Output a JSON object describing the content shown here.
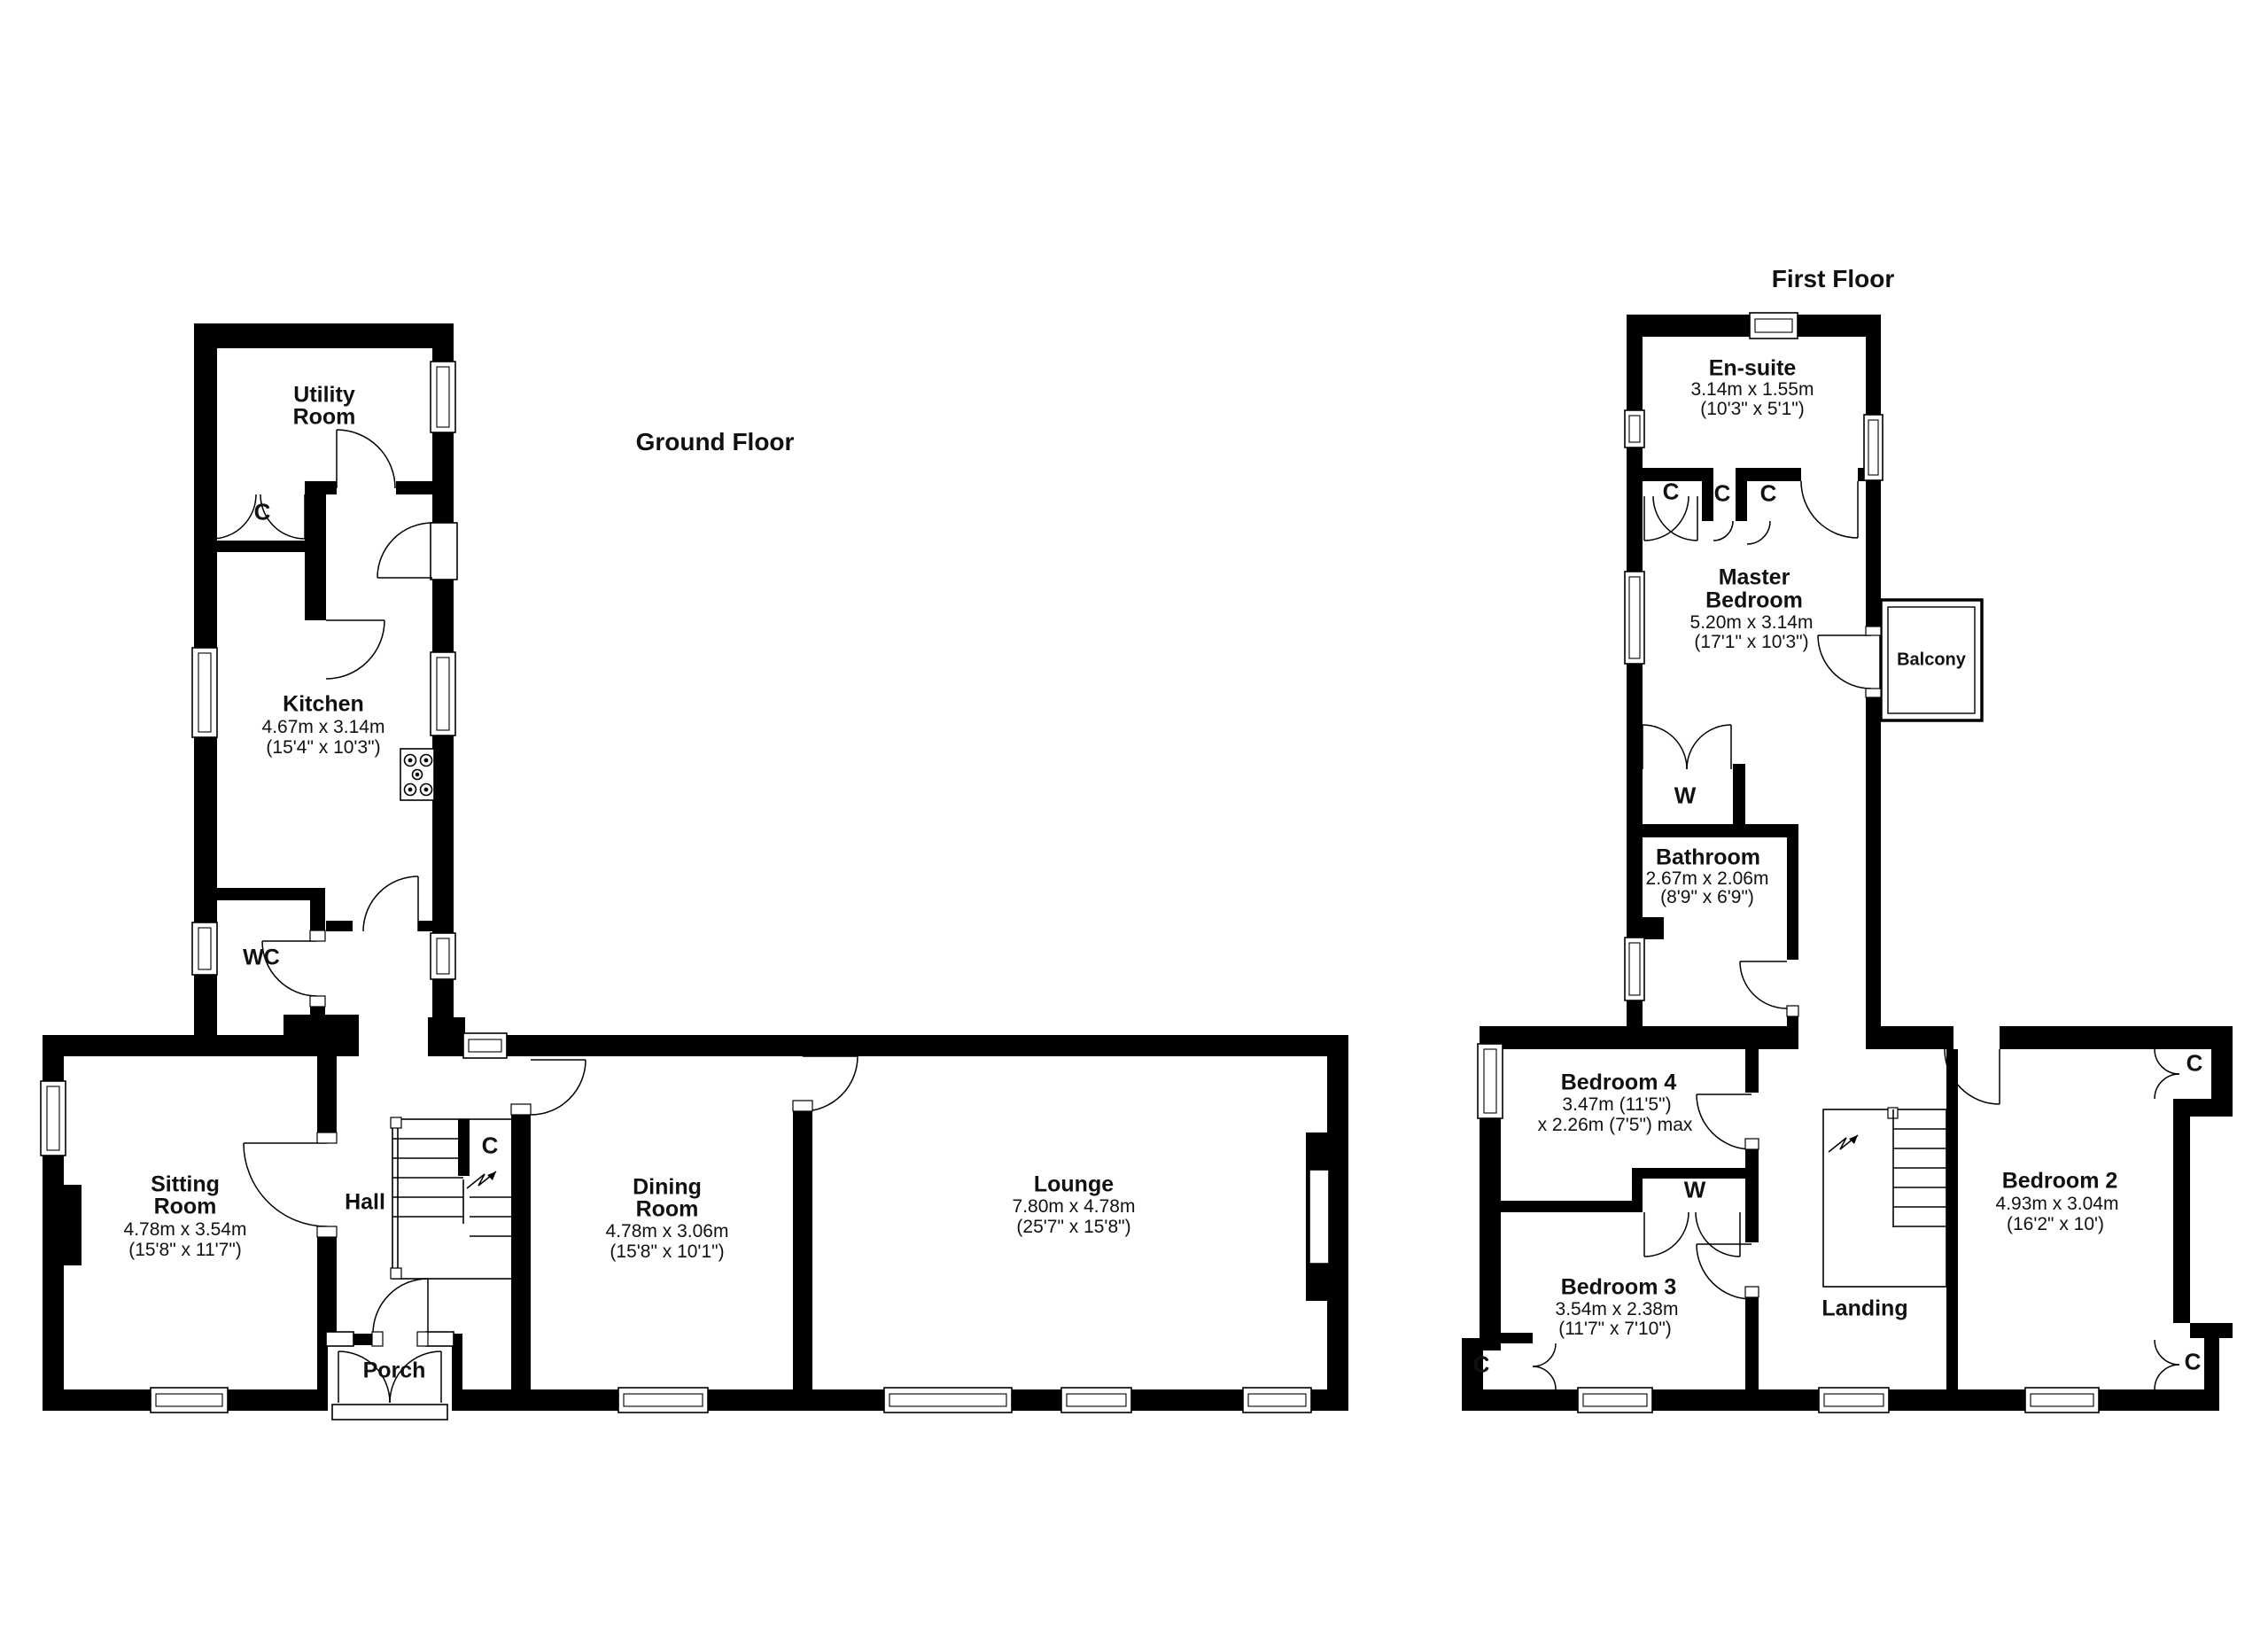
{
  "colors": {
    "wall": "#000000",
    "background": "#ffffff",
    "line": "#000000"
  },
  "ground_floor": {
    "title": "Ground Floor",
    "rooms": {
      "utility": {
        "name1": "Utility",
        "name2": "Room"
      },
      "kitchen": {
        "name": "Kitchen",
        "metric": "4.67m x 3.14m",
        "imperial": "(15'4\" x 10'3\")"
      },
      "wc": {
        "name": "WC"
      },
      "sitting": {
        "name1": "Sitting",
        "name2": "Room",
        "metric": "4.78m x 3.54m",
        "imperial": "(15'8\" x 11'7\")"
      },
      "hall": {
        "name": "Hall"
      },
      "porch": {
        "name": "Porch"
      },
      "dining": {
        "name1": "Dining",
        "name2": "Room",
        "metric": "4.78m x 3.06m",
        "imperial": "(15'8\" x 10'1\")"
      },
      "lounge": {
        "name": "Lounge",
        "metric": "7.80m x 4.78m",
        "imperial": "(25'7\" x 15'8\")"
      }
    },
    "markers": {
      "utility_cupboard": "C",
      "understairs_cupboard": "C"
    }
  },
  "first_floor": {
    "title": "First Floor",
    "rooms": {
      "ensuite": {
        "name": "En-suite",
        "metric": "3.14m x 1.55m",
        "imperial": "(10'3\" x 5'1\")"
      },
      "master": {
        "name1": "Master",
        "name2": "Bedroom",
        "metric": "5.20m x 3.14m",
        "imperial": "(17'1\" x 10'3\")"
      },
      "bathroom": {
        "name": "Bathroom",
        "metric": "2.67m x 2.06m",
        "imperial": "(8'9\" x 6'9\")"
      },
      "bedroom4": {
        "name": "Bedroom 4",
        "metric": "3.47m (11'5\")",
        "imperial": "x 2.26m (7'5\") max"
      },
      "bedroom3": {
        "name": "Bedroom 3",
        "metric": "3.54m x 2.38m",
        "imperial": "(11'7\" x 7'10\")"
      },
      "bedroom2": {
        "name": "Bedroom 2",
        "metric": "4.93m x 3.04m",
        "imperial": "(16'2\" x 10')"
      },
      "landing": {
        "name": "Landing"
      },
      "balcony": {
        "name": "Balcony"
      }
    },
    "markers": {
      "c1": "C",
      "c2": "C",
      "c3": "C",
      "master_wardrobe": "W",
      "bed3_wardrobe": "W",
      "bed3_cupboard": "C",
      "bed2_cupboard_top": "C",
      "bed2_cupboard_bottom": "C"
    }
  }
}
